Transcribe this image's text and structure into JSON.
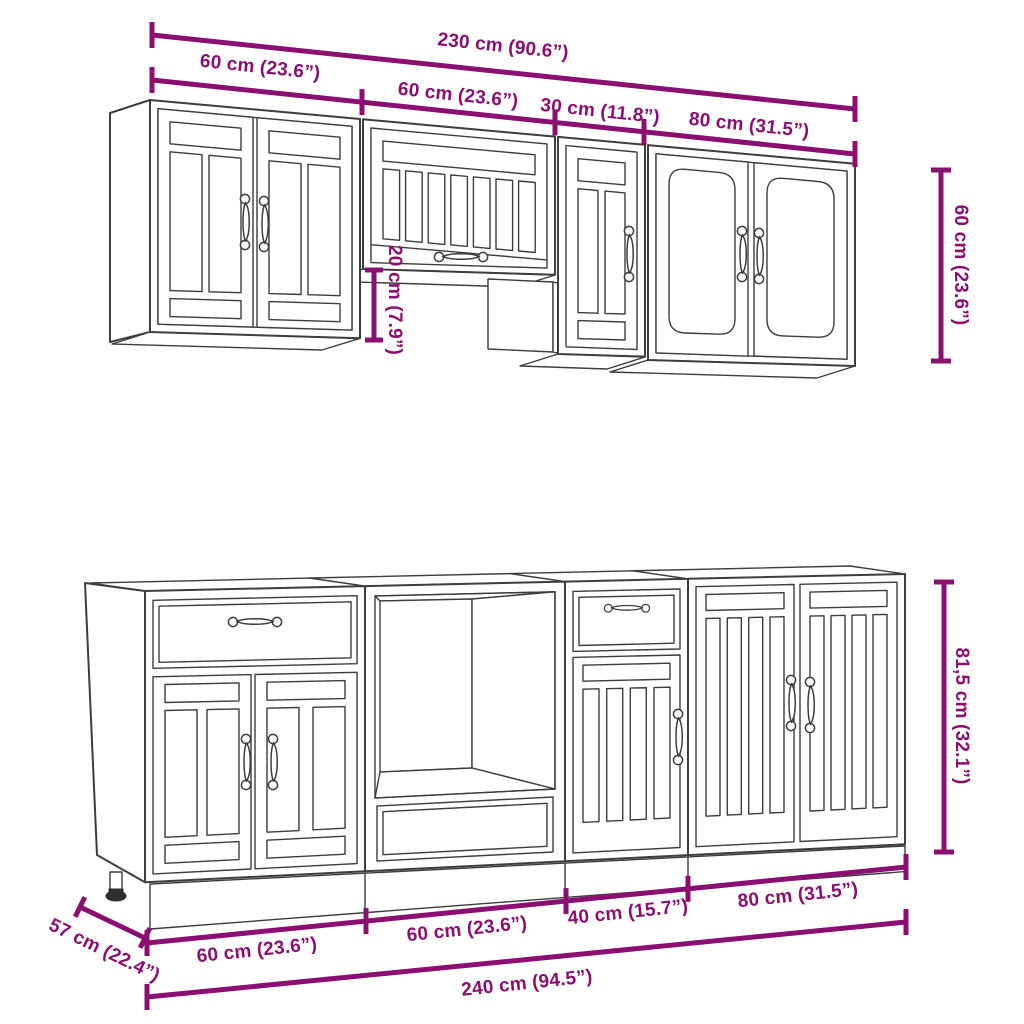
{
  "title": "Kitchen cabinet set dimension diagram",
  "colors": {
    "dimension_accent": "#8a0f70",
    "line_art": "#3d3d3d",
    "background": "#ffffff"
  },
  "wall_section": {
    "total_width": "230 cm (90.6”)",
    "cabinet_widths": [
      "60 cm (23.6”)",
      "60 cm (23.6”)",
      "30 cm (11.8”)",
      "80 cm (31.5”)"
    ],
    "cabinet_height": "60 cm (23.6”)",
    "bridge_drop": "20 cm (7.9”)"
  },
  "base_section": {
    "cabinet_widths": [
      "60 cm (23.6”)",
      "60 cm (23.6”)",
      "40 cm (15.7”)",
      "80 cm (31.5”)"
    ],
    "total_width": "240 cm (94.5”)",
    "depth": "57 cm (22.4”)",
    "cabinet_height": "81,5 cm (32.1”)"
  }
}
